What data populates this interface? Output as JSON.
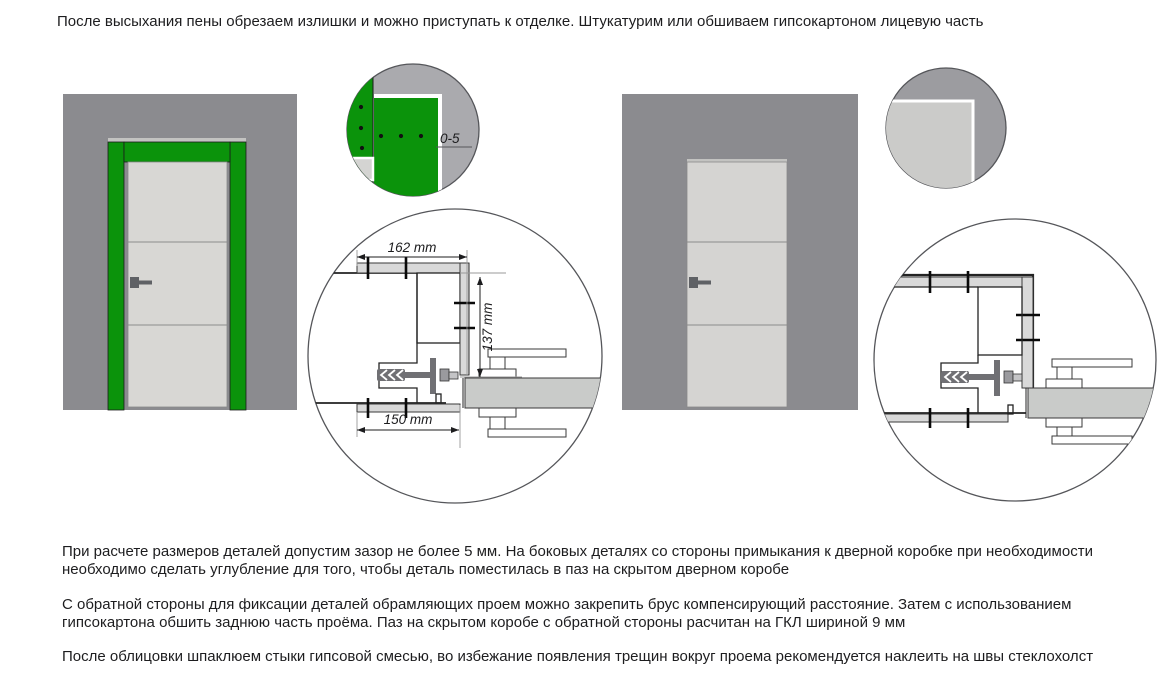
{
  "intro_text": "После высыхания пены обрезаем излишки и можно приступать к отделке. Штукатурим или обшиваем гипсокартоном лицевую часть",
  "paragraphs": {
    "p1": "При расчете размеров деталей допустим зазор не более 5 мм. На боковых деталях со стороны примыкания к дверной коробке при необходимости\nнеобходимо сделать углубление для того, чтобы деталь поместилась в паз на скрытом дверном коробе",
    "p2": "С обратной стороны для фиксации деталей обрамляющих проем можно закрепить брус компенсирующий расстояние. Затем с использованием\nгипсокартона обшить заднюю часть проёма. Паз на скрытом коробе с обратной стороны расчитан на ГКЛ шириной 9 мм",
    "p3": "После облицовки шпаклюем стыки гипсовой смесью, во избежание появления трещин вокруг проема рекомендуется наклеить на швы стеклохолст"
  },
  "labels": {
    "gap": "0-5",
    "dim_top": "162 mm",
    "dim_side": "137 mm",
    "dim_bottom": "150 mm"
  },
  "colors": {
    "wall": "#8b8b8f",
    "frame_green": "#0b930b",
    "door_leaf": "#d8d7d4",
    "door_leaf_right": "#d5d4d2",
    "board": "#d9d9d9",
    "anchor": "#707074",
    "leaf_section": "#c9cbc9",
    "detail_bg_left": "#aaaaae",
    "detail_bg_right": "#9c9ca0",
    "detail_inner_right": "#cbcbc9",
    "lintel": "#c3c3c1"
  }
}
